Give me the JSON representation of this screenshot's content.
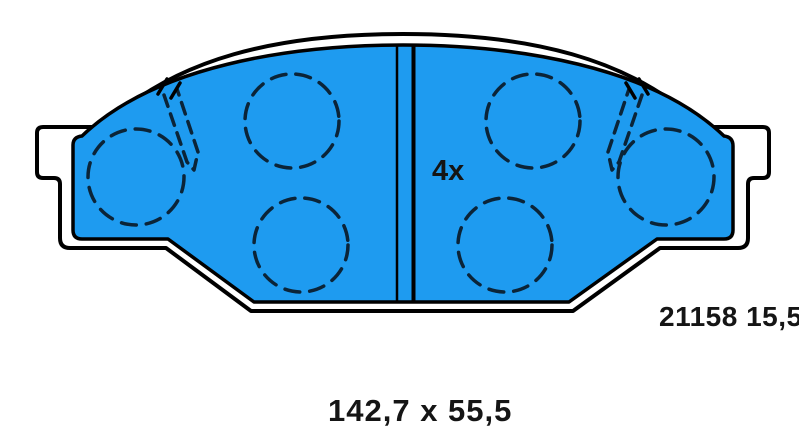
{
  "diagram": {
    "type": "brake-pad-set-technical-drawing",
    "quantity_label": "4x",
    "part_number": "21158 15,5",
    "dimensions_label": "142,7 x 55,5",
    "colors": {
      "pad_fill": "#1E9BF0",
      "outline": "#000000",
      "dash_stroke": "#0B2438",
      "background": "#FFFFFF"
    }
  }
}
